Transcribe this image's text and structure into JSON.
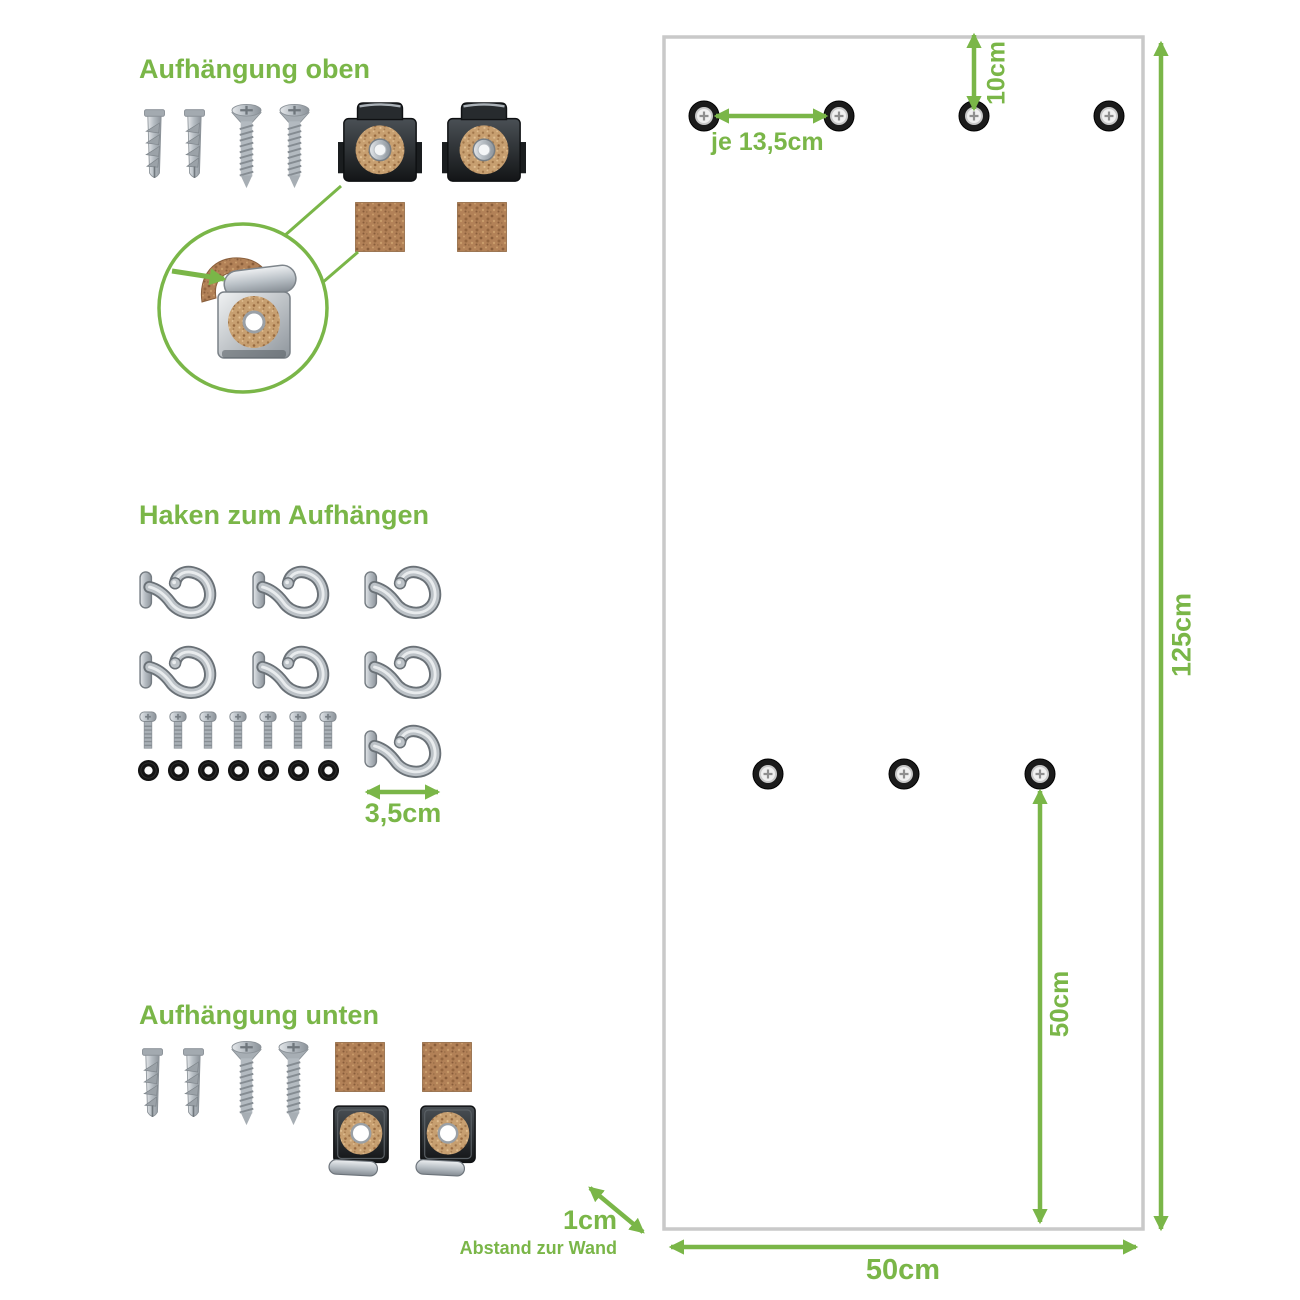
{
  "colors": {
    "accent_green": "#7ab648",
    "panel_border": "#c9c9c9",
    "cork": "#b28157",
    "metal": "#aab1b7",
    "dark_clip": "#24282b"
  },
  "sections": {
    "top_mount": {
      "title": "Aufhängung oben"
    },
    "hooks": {
      "title": "Haken zum Aufhängen",
      "hook_width": "3,5cm"
    },
    "bottom_mount": {
      "title": "Aufhängung unten"
    }
  },
  "panel": {
    "hole_spacing": "je 13,5cm",
    "top_offset": "10cm",
    "height": "125cm",
    "lower_hole_height": "50cm",
    "width": "50cm",
    "wall_gap": "1cm",
    "wall_gap_caption": "Abstand zur Wand"
  }
}
